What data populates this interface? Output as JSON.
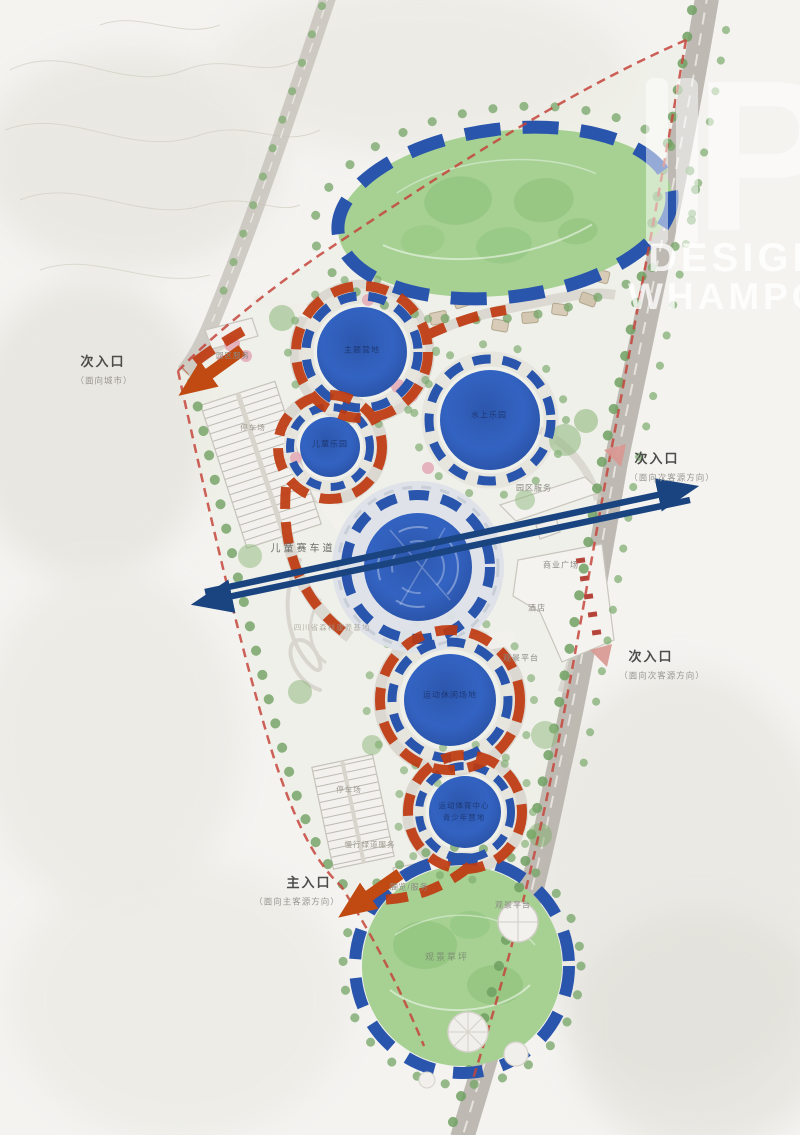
{
  "plan": {
    "type": "landscape-masterplan",
    "colors": {
      "loop_orange": "#bf3a10",
      "ring_blue": "#2a55ac",
      "axis_navy": "#1a4480",
      "boundary_red": "#c5453c",
      "lawn_green": "#a6d193",
      "pond_blue": "#3060bd",
      "road_gray": "#b8b4ac"
    }
  },
  "logo": {
    "monogram": "TP",
    "line1": "DESIGN",
    "line2": "WHAMPOA"
  },
  "labels": {
    "entrance_left_title": "次入口",
    "entrance_left_sub": "（面向城市）",
    "entrance_right1_title": "次入口",
    "entrance_right1_sub": "（面向次客源方向）",
    "entrance_right2_title": "次入口",
    "entrance_right2_sub": "（面向次客源方向）",
    "entrance_main_title": "主入口",
    "entrance_main_sub": "（面向主客源方向）",
    "kart_track": "儿童赛车道",
    "park_service_left": "园区服务",
    "park_service_right": "园区服务",
    "commercial_plaza": "商业广场",
    "hotel": "酒店",
    "viewing_platform_mid": "观景平台",
    "viewing_platform_bottom": "观景平台",
    "viewing_lawn": "观景草坪",
    "exhibition_service": "展览/服务",
    "greenway_service": "慢行绿道服务",
    "parking_left": "停车场",
    "parking_bottom": "停车场",
    "site_note": "四川省森林康养基地",
    "zone1": "主题营地",
    "zone2": "水上乐园",
    "zone3": "儿童乐园",
    "zone5": "运动休闲场地",
    "zone6_line1": "运动体育中心",
    "zone6_line2": "青少年营地"
  }
}
